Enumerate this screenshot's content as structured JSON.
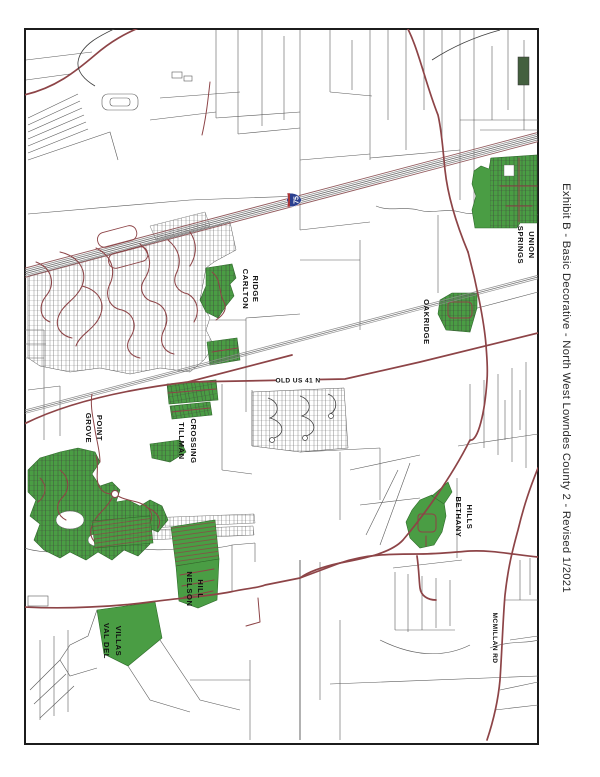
{
  "title": {
    "text": "Exhibit B - Basic Decorative - North West Lowndes County 2 - Revised 1/2021"
  },
  "map": {
    "interstate_shield": {
      "route": "75"
    },
    "road_labels": {
      "old_us_41": "OLD US 41 N",
      "mcmillan_rd": "MCMILLAN RD"
    },
    "subdivisions": {
      "union_springs": {
        "line1": "UNION",
        "line2": "SPRINGS"
      },
      "carlton_ridge": {
        "line1": "CARLTON",
        "line2": "RIDGE"
      },
      "oakridge": {
        "name": "OAKRIDGE"
      },
      "grove_pointe": {
        "line1": "GROVE",
        "line2": "POINT"
      },
      "tillman_crossing": {
        "line1": "TILLMAN",
        "line2": "CROSSING"
      },
      "bethany_hills": {
        "line1": "BETHANY",
        "line2": "HILLS"
      },
      "nelson_hill": {
        "line1": "NELSON",
        "line2": "HILL"
      },
      "val_del_villas": {
        "line1": "VAL DEL",
        "line2": "VILLAS"
      }
    },
    "colors": {
      "subdivision_green": "#4a9d44",
      "road_red": "#8d4447",
      "parcel_line": "#5a5a5a",
      "corridor_gray": "#8a8a8a",
      "frame_black": "#1c1c1c"
    }
  }
}
